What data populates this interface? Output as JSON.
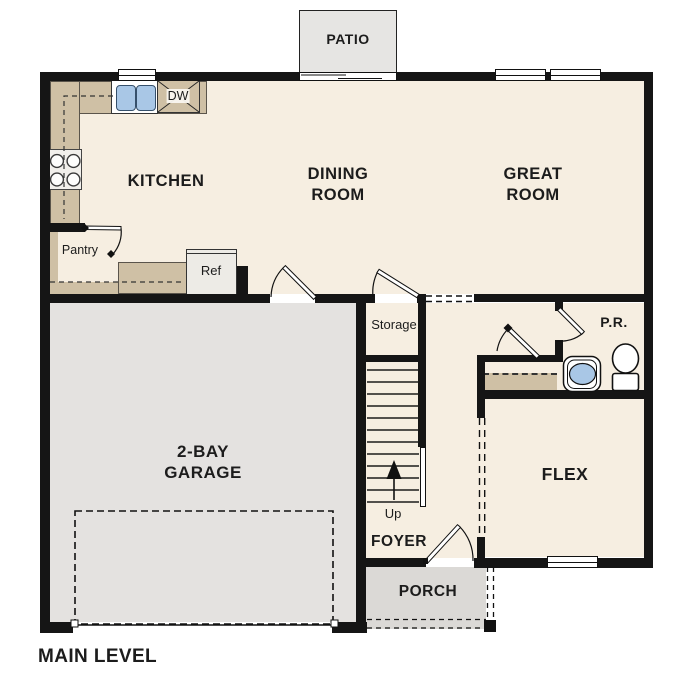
{
  "title": "MAIN LEVEL",
  "rooms": {
    "patio": "PATIO",
    "kitchen": "KITCHEN",
    "dining_room_line1": "DINING",
    "dining_room_line2": "ROOM",
    "great_room_line1": "GREAT",
    "great_room_line2": "ROOM",
    "garage_line1": "2-BAY",
    "garage_line2": "GARAGE",
    "flex": "FLEX",
    "foyer": "FOYER",
    "porch": "PORCH",
    "storage": "Storage",
    "pantry": "Pantry",
    "powder_room": "P.R."
  },
  "fixtures": {
    "refrigerator": "Ref",
    "dishwasher": "DW",
    "stairs_direction": "Up"
  },
  "colors": {
    "wall": "#151515",
    "floor": "#f6eee1",
    "garage_floor": "#e4e2e0",
    "porch_floor": "#dbd9d6",
    "patio_floor": "#e6e5e3",
    "counter": "#cfc0a5",
    "water_blue": "#a9c7e6"
  }
}
